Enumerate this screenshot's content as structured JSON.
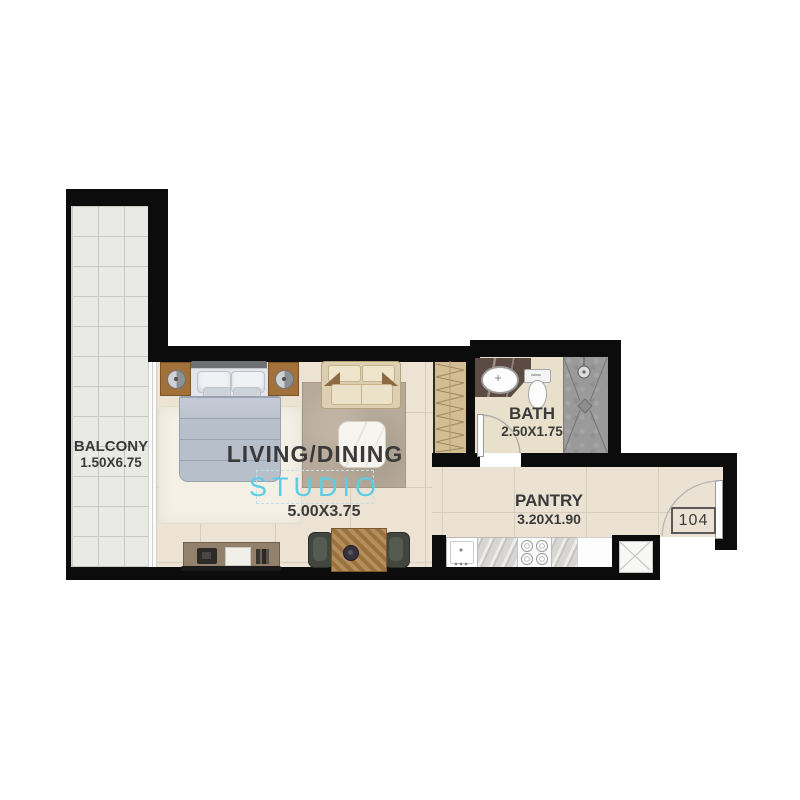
{
  "plan": {
    "title": "Studio unit floor plan",
    "watermark": "STUDIO",
    "unit_number": "104",
    "rooms": {
      "balcony": {
        "name": "BALCONY",
        "dims": "1.50X6.75"
      },
      "living": {
        "name": "LIVING/DINING",
        "dims": "5.00X3.75"
      },
      "bath": {
        "name": "BATH",
        "dims": "2.50X1.75"
      },
      "pantry": {
        "name": "PANTRY",
        "dims": "3.20X1.90"
      }
    },
    "colors": {
      "wall": "#0c0c0c",
      "living_floor": "#ece3d4",
      "balcony_floor": "#e9e9e6",
      "bath_floor": "#e8e0ca",
      "shower": "#9a9a9a",
      "wardrobe": "#d3bd93",
      "watermark_accent": "#5bcde6",
      "label_text": "#3a3a3a"
    },
    "furniture_icons": [
      "bed-icon",
      "nightstand-icon",
      "lamp-icon",
      "sofa-icon",
      "coffee-table-icon",
      "rug-icon",
      "tv-console-icon",
      "dining-table-icon",
      "chair-icon",
      "wardrobe-icon",
      "washbasin-icon",
      "toilet-icon",
      "shower-icon",
      "kitchen-sink-icon",
      "stove-icon",
      "fridge-counter-icon",
      "door-swing-icon",
      "shaft-icon"
    ]
  }
}
